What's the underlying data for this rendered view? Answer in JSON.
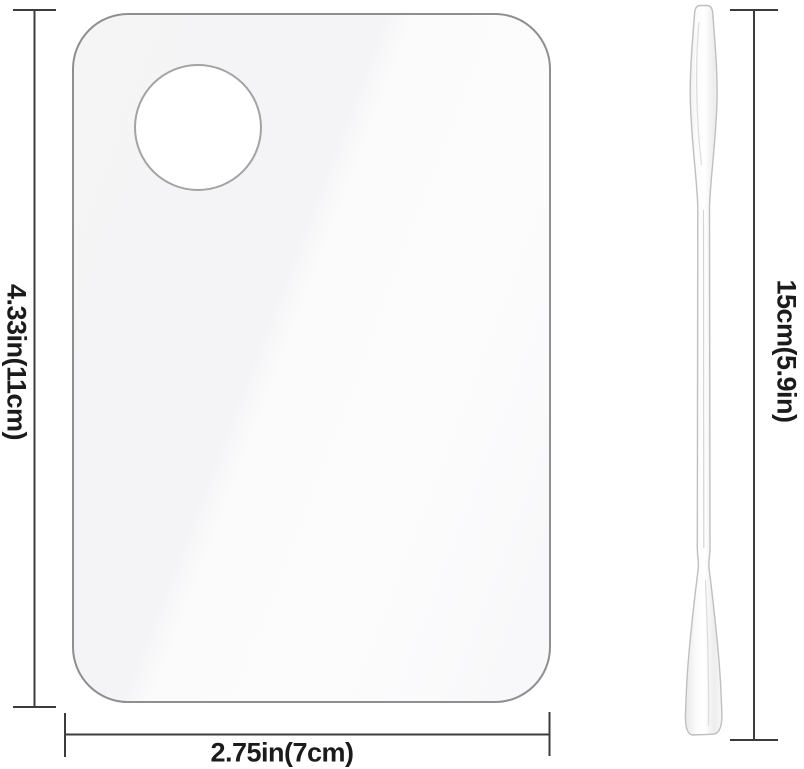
{
  "scene": {
    "type": "product-dimension-diagram",
    "items": {
      "palette": {
        "name": "clear makeup mixing palette with thumb hole",
        "height_label": "4.33in(11cm)",
        "width_label": "2.75in(7cm)"
      },
      "spatula": {
        "name": "double-ended mixing spatula",
        "length_label": "15cm(5.9in)"
      }
    },
    "colors": {
      "background": "#ffffff",
      "dimension_line": "#3c3c3c",
      "label_text": "#1b1b1b",
      "palette_border": "#8f8f8f",
      "palette_fill_light": "#fcfcfd",
      "palette_fill_shade": "#f4f4f6",
      "thumb_hole_fill": "#ffffff",
      "tool_outline": "#bfbfbf",
      "tool_fill": "#fafafa"
    }
  }
}
